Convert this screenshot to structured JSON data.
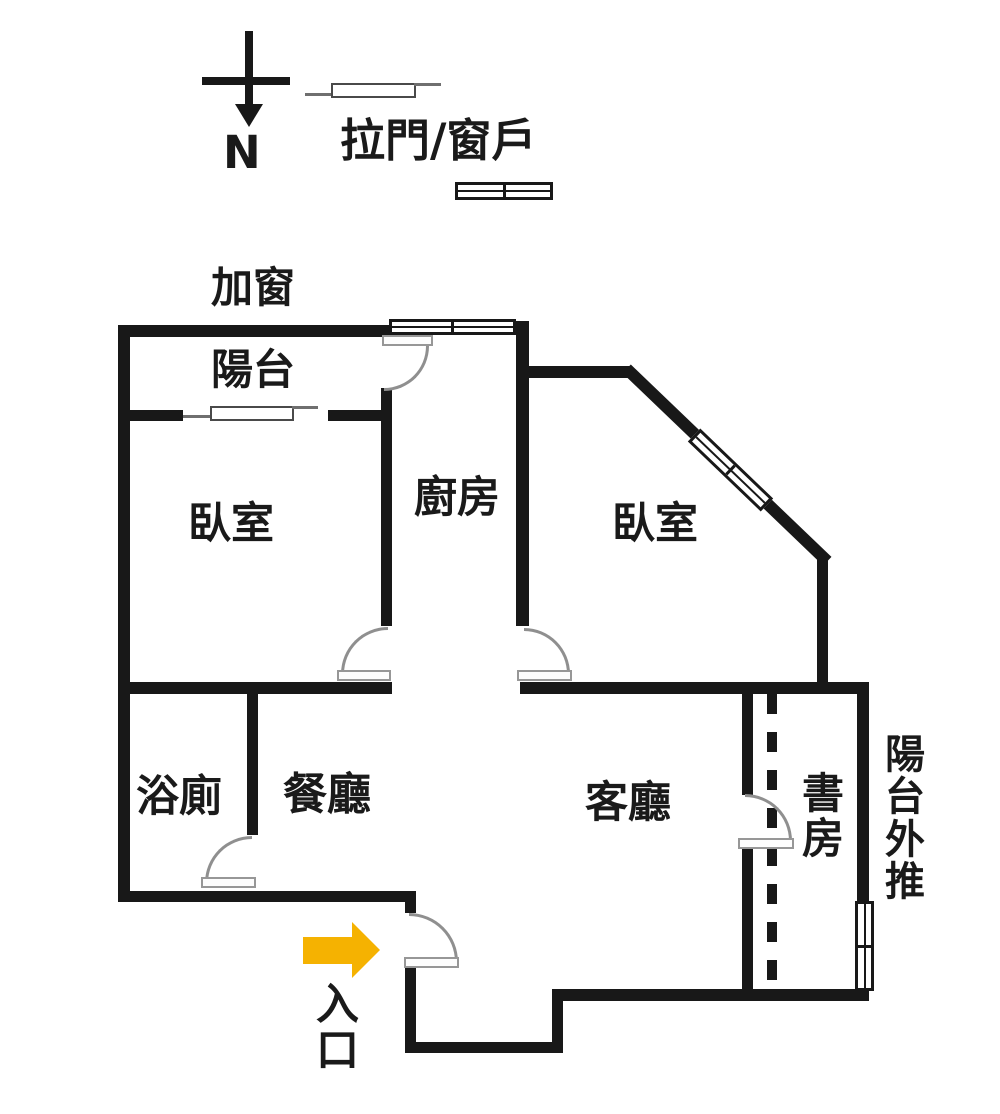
{
  "compass": {
    "north_label": "N"
  },
  "legend": {
    "label": "拉門/窗戶"
  },
  "plan": {
    "note_top": "加窗",
    "rooms": {
      "balcony": "陽台",
      "bedroom_left": "臥室",
      "kitchen": "廚房",
      "bedroom_right": "臥室",
      "bathroom": "浴廁",
      "dining": "餐廳",
      "living": "客廳",
      "study": "書房"
    },
    "note_right": "陽台外推",
    "entrance_label": "入口"
  },
  "colors": {
    "wall": "#181818",
    "door_symbol": "#8f8f8f",
    "window_border": "#181818",
    "entrance_arrow": "#f5b201",
    "background": "#ffffff"
  }
}
